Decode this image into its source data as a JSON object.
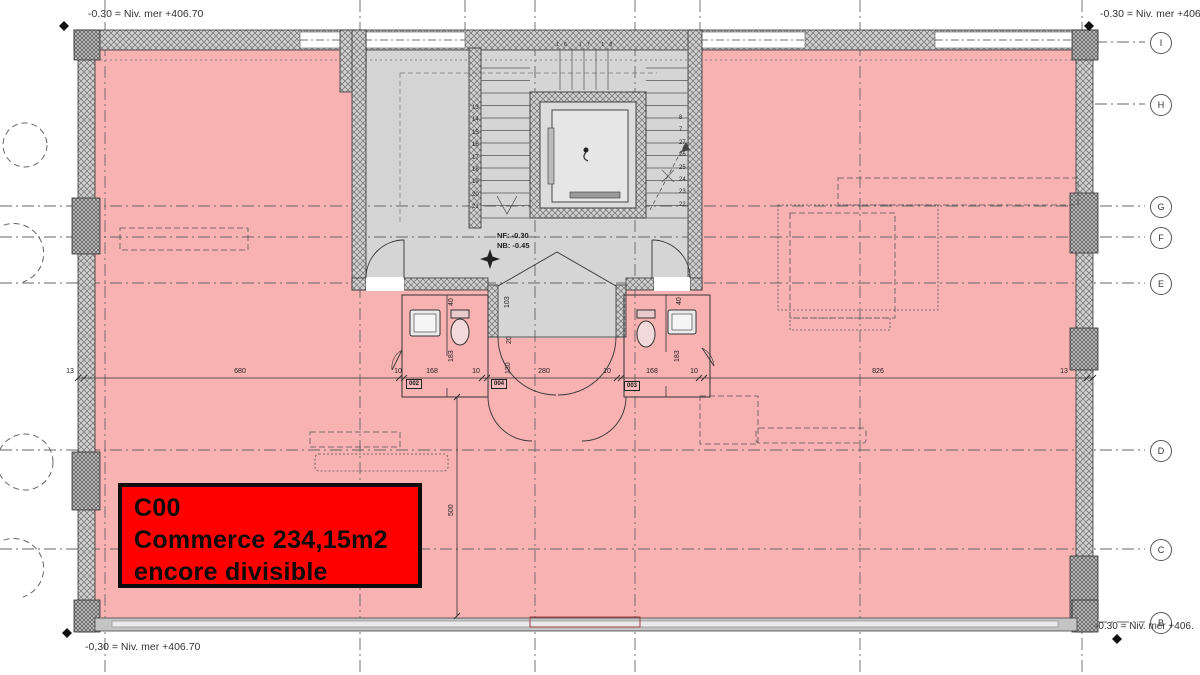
{
  "title": "Plan rez-de-chaussée — surface commerciale",
  "colors": {
    "commerce_pink": "#f8b2b2",
    "core_gray": "#d5d5d5",
    "highlight_red": "#ff0000",
    "line_dark": "#3c3c3c"
  },
  "unit_label": {
    "code": "C00",
    "area": "Commerce 234,15m2",
    "note": "encore divisible"
  },
  "levels": {
    "top_left": "-0.30 = Niv. mer +406.70",
    "top_right": "-0.30 = Niv. mer +406.",
    "bottom_left": "-0,30 = Niv. mer +406.70",
    "bottom_right": "-0.30 = Niv. mer +406.",
    "floor_note_1": "NF: -0.30",
    "floor_note_2": "NB: -0.45"
  },
  "grid_markers": [
    {
      "label": "I"
    },
    {
      "label": "H"
    },
    {
      "label": "G"
    },
    {
      "label": "F"
    },
    {
      "label": "E"
    },
    {
      "label": "D"
    },
    {
      "label": "C"
    },
    {
      "label": "B"
    }
  ],
  "dim_h": [
    "13",
    "680",
    "10",
    "168",
    "10",
    "280",
    "10",
    "168",
    "10",
    "826",
    "13"
  ],
  "dim_v": {
    "wc_left_top": "40",
    "wc_left_depth": "183",
    "vest_top": "103",
    "vest_mid": "20",
    "vest_low": "130",
    "wc_right_top": "40",
    "wc_right_depth": "183",
    "commerce_depth": "500"
  },
  "rooms": [
    {
      "number": "002"
    },
    {
      "number": "004"
    },
    {
      "number": "003"
    }
  ],
  "stairs": {
    "left_steps": "13\n14\n15\n16\n17\n18\n19\n20\n21",
    "right_steps": "8\n7\n27\n26\n25\n24\n23\n22",
    "top_steps": "16 17 18"
  }
}
